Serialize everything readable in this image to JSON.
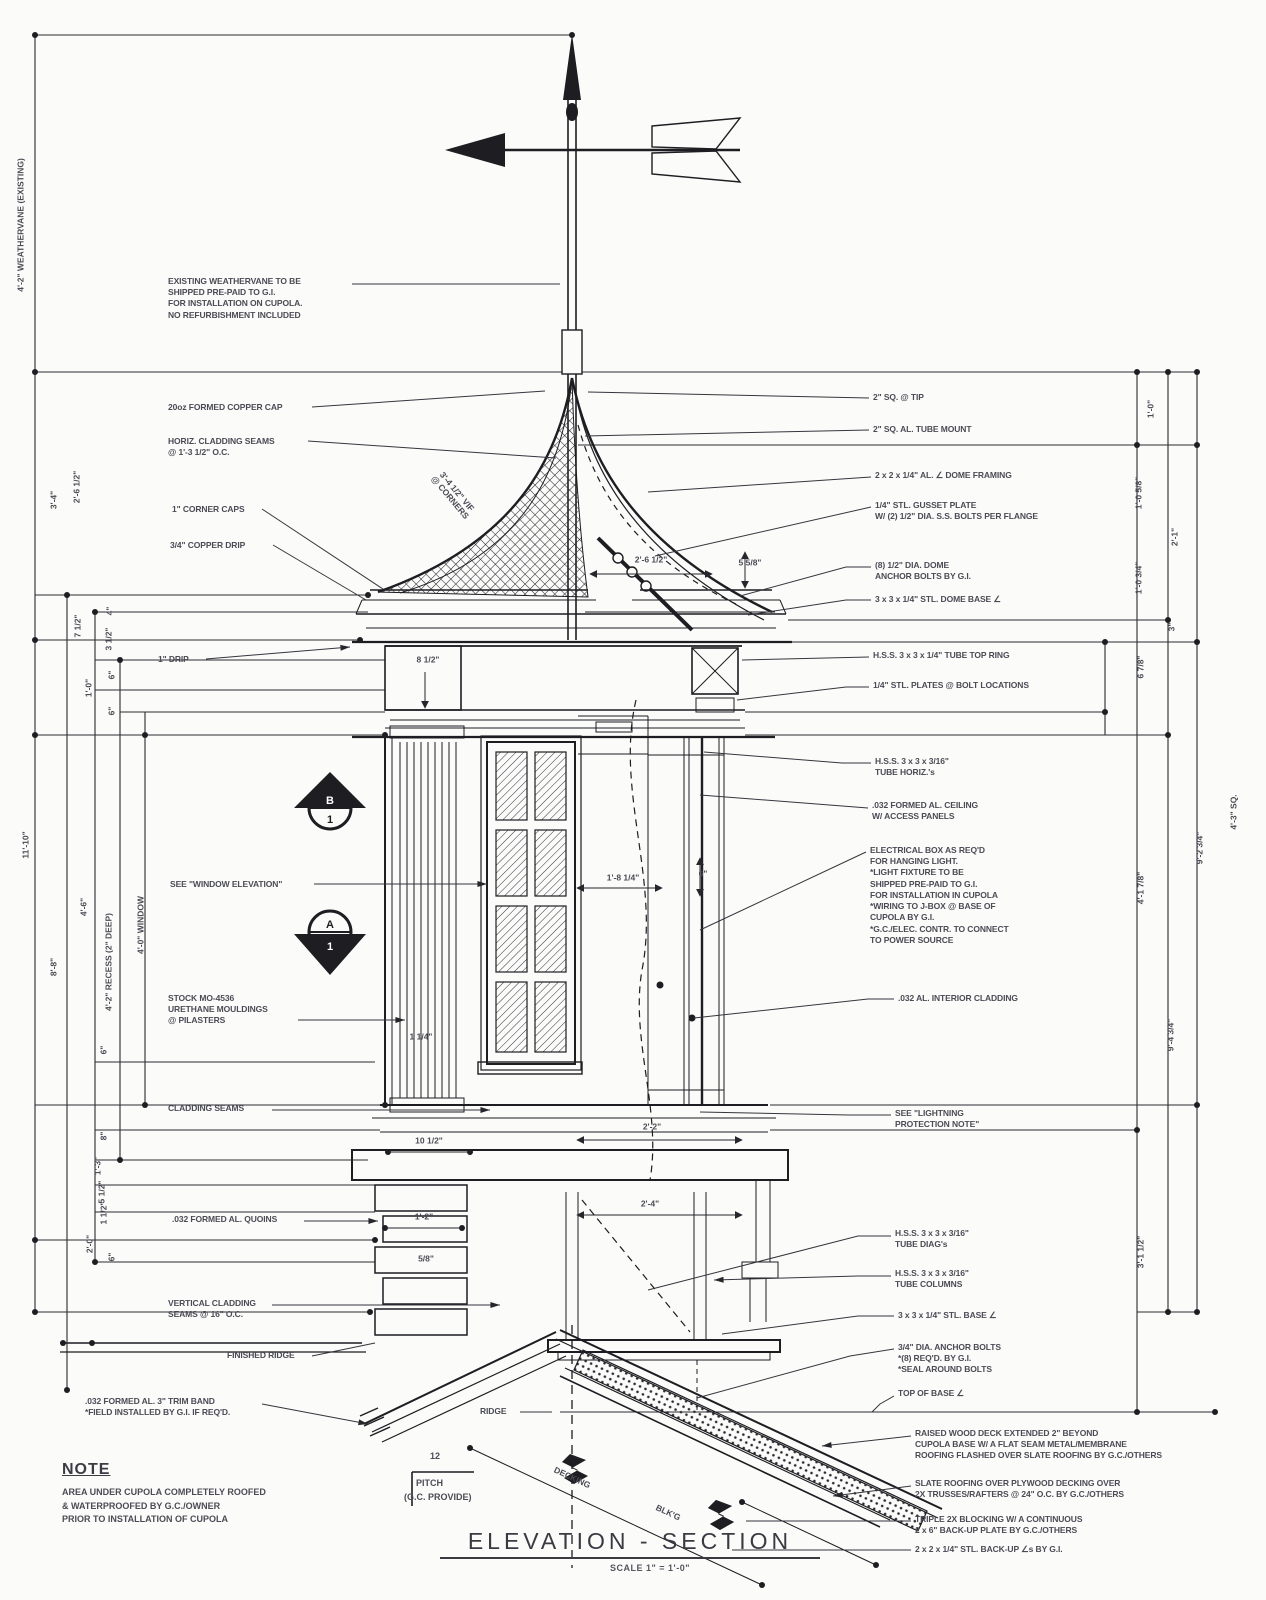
{
  "sheet": {
    "background": "#fbfbfa",
    "ink": "#26262c",
    "annotation_ink": "#4b4b55"
  },
  "title": {
    "main": "ELEVATION - SECTION",
    "scale": "SCALE 1\" = 1'-0\""
  },
  "note": {
    "heading": "NOTE",
    "body": "AREA UNDER CUPOLA COMPLETELY ROOFED\n& WATERPROOFED BY G.C./OWNER\nPRIOR TO INSTALLATION OF CUPOLA"
  },
  "pitch": {
    "rise": "12",
    "label_line1": "PITCH",
    "label_line2": "(G.C. PROVIDE)"
  },
  "section_markers": [
    {
      "top": "B",
      "bottom": "1"
    },
    {
      "top": "A",
      "bottom": "1"
    }
  ],
  "callouts": [
    {
      "name": "existing-weathervane-note",
      "x": 168,
      "y": 276,
      "text": "EXISTING WEATHERVANE TO BE\nSHIPPED PRE-PAID TO G.I.\nFOR INSTALLATION ON CUPOLA.\nNO REFURBISHMENT INCLUDED",
      "leader": [
        [
          352,
          284
        ],
        [
          560,
          284
        ]
      ],
      "arrow": false
    },
    {
      "name": "copper-cap-note",
      "x": 168,
      "y": 402,
      "text": "20oz FORMED COPPER CAP",
      "leader": [
        [
          312,
          407
        ],
        [
          545,
          391
        ]
      ],
      "arrow": false
    },
    {
      "name": "horiz-cladding-seams-note",
      "x": 168,
      "y": 436,
      "text": "HORIZ. CLADDING SEAMS\n@ 1'-3 1/2\" O.C.",
      "leader": [
        [
          308,
          441
        ],
        [
          556,
          458
        ]
      ],
      "arrow": false
    },
    {
      "name": "corner-caps-note",
      "x": 172,
      "y": 504,
      "text": "1\" CORNER CAPS",
      "leader": [
        [
          262,
          509
        ],
        [
          383,
          589
        ]
      ],
      "arrow": false
    },
    {
      "name": "copper-drip-note",
      "x": 170,
      "y": 540,
      "text": "3/4\" COPPER DRIP",
      "leader": [
        [
          273,
          545
        ],
        [
          366,
          600
        ]
      ],
      "arrow": false
    },
    {
      "name": "one-inch-drip-note",
      "x": 158,
      "y": 654,
      "text": "1\" DRIP",
      "leader": [
        [
          206,
          659
        ],
        [
          350,
          647
        ]
      ],
      "arrow": true
    },
    {
      "name": "window-elevation-note",
      "x": 170,
      "y": 879,
      "text": "SEE \"WINDOW ELEVATION\"",
      "leader": [
        [
          314,
          884
        ],
        [
          487,
          884
        ]
      ],
      "arrow": true
    },
    {
      "name": "urethane-mouldings-note",
      "x": 168,
      "y": 993,
      "text": "STOCK MO-4536\nURETHANE MOULDINGS\n@ PILASTERS",
      "leader": [
        [
          298,
          1020
        ],
        [
          405,
          1020
        ]
      ],
      "arrow": true
    },
    {
      "name": "cladding-seams-note",
      "x": 168,
      "y": 1103,
      "text": "CLADDING SEAMS",
      "leader": [
        [
          272,
          1110
        ],
        [
          490,
          1110
        ]
      ],
      "arrow": true
    },
    {
      "name": "quoins-note",
      "x": 172,
      "y": 1214,
      "text": ".032 FORMED AL. QUOINS",
      "leader": [
        [
          304,
          1221
        ],
        [
          378,
          1221
        ]
      ],
      "arrow": true
    },
    {
      "name": "vertical-cladding-seams-note",
      "x": 168,
      "y": 1298,
      "text": "VERTICAL CLADDING\nSEAMS @ 16\" O.C.",
      "leader": [
        [
          272,
          1305
        ],
        [
          500,
          1305
        ]
      ],
      "arrow": true
    },
    {
      "name": "finished-ridge-note",
      "x": 227,
      "y": 1350,
      "text": "FINISHED RIDGE",
      "leader": [
        [
          312,
          1356
        ],
        [
          375,
          1343
        ]
      ],
      "arrow": false
    },
    {
      "name": "trim-band-note",
      "x": 85,
      "y": 1396,
      "text": ".032 FORMED AL. 3\" TRIM BAND\n*FIELD INSTALLED BY G.I. IF REQ'D.",
      "leader": [
        [
          262,
          1404
        ],
        [
          368,
          1424
        ]
      ],
      "arrow": true
    },
    {
      "name": "ridge-label",
      "x": 480,
      "y": 1406,
      "text": "RIDGE",
      "leader": [
        [
          520,
          1412
        ],
        [
          552,
          1412
        ]
      ],
      "arrow": false
    },
    {
      "name": "tip-note",
      "x": 873,
      "y": 392,
      "text": "2\" SQ. @ TIP",
      "leader": [
        [
          869,
          398
        ],
        [
          588,
          392
        ]
      ],
      "arrow": false
    },
    {
      "name": "tube-mount-note",
      "x": 873,
      "y": 424,
      "text": "2\" SQ. AL. TUBE MOUNT",
      "leader": [
        [
          869,
          430
        ],
        [
          585,
          436
        ]
      ],
      "arrow": false
    },
    {
      "name": "dome-framing-note",
      "x": 875,
      "y": 470,
      "text": "2 x 2 x 1/4\" AL. ∠ DOME FRAMING",
      "leader": [
        [
          871,
          477
        ],
        [
          648,
          492
        ]
      ],
      "arrow": false
    },
    {
      "name": "gusset-plate-note",
      "x": 875,
      "y": 500,
      "text": "1/4\" STL. GUSSET PLATE\nW/ (2) 1/2\" DIA. S.S. BOLTS PER FLANGE",
      "leader": [
        [
          871,
          507
        ],
        [
          655,
          556
        ]
      ],
      "arrow": false
    },
    {
      "name": "dome-anchor-bolts-note",
      "x": 875,
      "y": 560,
      "text": "(8) 1/2\" DIA. DOME\nANCHOR BOLTS BY G.I.",
      "leader": [
        [
          871,
          567
        ],
        [
          846,
          567
        ],
        [
          740,
          596
        ]
      ],
      "arrow": false
    },
    {
      "name": "dome-base-angle-note",
      "x": 875,
      "y": 594,
      "text": "3 x 3 x 1/4\" STL. DOME BASE ∠",
      "leader": [
        [
          871,
          600
        ],
        [
          846,
          600
        ],
        [
          748,
          615
        ]
      ],
      "arrow": false
    },
    {
      "name": "tube-top-ring-note",
      "x": 873,
      "y": 650,
      "text": "H.S.S. 3 x 3 x 1/4\" TUBE TOP RING",
      "leader": [
        [
          869,
          657
        ],
        [
          742,
          660
        ]
      ],
      "arrow": false
    },
    {
      "name": "stl-plates-note",
      "x": 873,
      "y": 680,
      "text": "1/4\" STL. PLATES @ BOLT LOCATIONS",
      "leader": [
        [
          869,
          687
        ],
        [
          846,
          687
        ],
        [
          737,
          700
        ]
      ],
      "arrow": false
    },
    {
      "name": "tube-horiz-note",
      "x": 875,
      "y": 756,
      "text": "H.S.S. 3 x 3 x 3/16\"\nTUBE HORIZ.'s",
      "leader": [
        [
          871,
          763
        ],
        [
          842,
          763
        ],
        [
          704,
          752
        ]
      ],
      "arrow": false
    },
    {
      "name": "al-ceiling-note",
      "x": 872,
      "y": 800,
      "text": ".032 FORMED AL. CEILING\nW/ ACCESS PANELS",
      "leader": [
        [
          868,
          808
        ],
        [
          700,
          795
        ]
      ],
      "arrow": false
    },
    {
      "name": "electrical-box-note",
      "x": 870,
      "y": 845,
      "text": "ELECTRICAL BOX AS REQ'D\nFOR HANGING LIGHT.\n*LIGHT FIXTURE TO BE\nSHIPPED PRE-PAID TO G.I.\nFOR INSTALLATION IN CUPOLA\n*WIRING TO J-BOX @ BASE OF\nCUPOLA BY G.I.\n*G.C./ELEC. CONTR. TO CONNECT\nTO POWER SOURCE",
      "leader": [
        [
          866,
          852
        ],
        [
          700,
          930
        ]
      ],
      "arrow": false
    },
    {
      "name": "interior-cladding-note",
      "x": 898,
      "y": 993,
      "text": ".032 AL. INTERIOR CLADDING",
      "leader": [
        [
          894,
          999
        ],
        [
          868,
          999
        ],
        [
          694,
          1018
        ]
      ],
      "arrow": false
    },
    {
      "name": "lightning-protection-note",
      "x": 895,
      "y": 1108,
      "text": "SEE \"LIGHTNING\nPROTECTION NOTE\"",
      "leader": [
        [
          891,
          1115
        ],
        [
          848,
          1115
        ],
        [
          700,
          1112
        ]
      ],
      "arrow": false
    },
    {
      "name": "tube-diags-note",
      "x": 895,
      "y": 1228,
      "text": "H.S.S. 3 x 3 x 3/16\"\nTUBE DIAG's",
      "leader": [
        [
          891,
          1236
        ],
        [
          858,
          1236
        ],
        [
          648,
          1290
        ]
      ],
      "arrow": false
    },
    {
      "name": "tube-columns-note",
      "x": 895,
      "y": 1268,
      "text": "H.S.S. 3 x 3 x 3/16\"\nTUBE COLUMNS",
      "leader": [
        [
          891,
          1276
        ],
        [
          858,
          1276
        ],
        [
          714,
          1280
        ]
      ],
      "arrow": true
    },
    {
      "name": "base-angle-note",
      "x": 898,
      "y": 1310,
      "text": "3 x 3 x 1/4\" STL. BASE ∠",
      "leader": [
        [
          894,
          1316
        ],
        [
          858,
          1316
        ],
        [
          722,
          1334
        ]
      ],
      "arrow": false
    },
    {
      "name": "anchor-bolts-note",
      "x": 898,
      "y": 1342,
      "text": "3/4\" DIA. ANCHOR BOLTS\n*(8) REQ'D. BY G.I.\n*SEAL AROUND BOLTS",
      "leader": [
        [
          894,
          1349
        ],
        [
          850,
          1356
        ],
        [
          697,
          1398
        ]
      ],
      "arrow": false
    },
    {
      "name": "top-of-base-note",
      "x": 898,
      "y": 1388,
      "text": "TOP OF BASE ∠",
      "leader": [
        [
          894,
          1396
        ],
        [
          880,
          1404
        ],
        [
          872,
          1412
        ]
      ],
      "arrow": false
    },
    {
      "name": "raised-deck-note",
      "x": 915,
      "y": 1428,
      "text": "RAISED WOOD DECK EXTENDED 2\" BEYOND\nCUPOLA BASE W/ A FLAT SEAM METAL/MEMBRANE\nROOFING FLASHED OVER SLATE ROOFING BY G.C./OTHERS",
      "leader": [
        [
          911,
          1436
        ],
        [
          822,
          1446
        ]
      ],
      "arrow": true
    },
    {
      "name": "slate-roofing-note",
      "x": 915,
      "y": 1478,
      "text": "SLATE ROOFING OVER PLYWOOD DECKING OVER\n2X TRUSSES/RAFTERS @ 24\" O.C. BY G.C./OTHERS",
      "leader": [
        [
          911,
          1486
        ],
        [
          833,
          1496
        ]
      ],
      "arrow": true
    },
    {
      "name": "blocking-note",
      "x": 915,
      "y": 1514,
      "text": "TRIPLE 2X BLOCKING W/ A CONTINUOUS\n2 x 6\" BACK-UP PLATE BY G.C./OTHERS",
      "leader": [
        [
          911,
          1521
        ],
        [
          746,
          1521
        ]
      ],
      "arrow": false
    },
    {
      "name": "backup-angles-note",
      "x": 915,
      "y": 1544,
      "text": "2 x 2 x 1/4\" STL. BACK-UP ∠s BY G.I.",
      "leader": [
        [
          911,
          1550
        ],
        [
          732,
          1550
        ]
      ],
      "arrow": false
    }
  ],
  "dims": [
    {
      "text": "4'-2\" WEATHERVANE (EXISTING)",
      "x": 21,
      "y": 225,
      "rot": -90
    },
    {
      "text": "3'-4\"",
      "x": 54,
      "y": 500,
      "rot": -90
    },
    {
      "text": "2'-6 1/2\"",
      "x": 77,
      "y": 487,
      "rot": -90
    },
    {
      "text": "11'-10\"",
      "x": 26,
      "y": 845,
      "rot": -90
    },
    {
      "text": "8'-8\"",
      "x": 54,
      "y": 967,
      "rot": -90
    },
    {
      "text": "4'-6\"",
      "x": 84,
      "y": 907,
      "rot": -90
    },
    {
      "text": "4'-2\" RECESS (2\" DEEP)",
      "x": 109,
      "y": 962,
      "rot": -90
    },
    {
      "text": "4'-0\" WINDOW",
      "x": 141,
      "y": 925,
      "rot": -90
    },
    {
      "text": "4\"",
      "x": 110,
      "y": 611,
      "rot": -90
    },
    {
      "text": "7 1/2\"",
      "x": 78,
      "y": 626,
      "rot": -90
    },
    {
      "text": "3 1/2\"",
      "x": 109,
      "y": 639,
      "rot": -90
    },
    {
      "text": "6\"",
      "x": 112,
      "y": 675,
      "rot": -90
    },
    {
      "text": "1'-0\"",
      "x": 89,
      "y": 688,
      "rot": -90
    },
    {
      "text": "6\"",
      "x": 112,
      "y": 711,
      "rot": -90
    },
    {
      "text": "6\"",
      "x": 104,
      "y": 1050,
      "rot": -90
    },
    {
      "text": "8\"",
      "x": 104,
      "y": 1136,
      "rot": -90
    },
    {
      "text": "1'-3\"",
      "x": 98,
      "y": 1166,
      "rot": -90
    },
    {
      "text": "5 1/2\"",
      "x": 102,
      "y": 1192,
      "rot": -90
    },
    {
      "text": "1 1/2\"",
      "x": 104,
      "y": 1213,
      "rot": -90
    },
    {
      "text": "2'-0\"",
      "x": 90,
      "y": 1244,
      "rot": -90
    },
    {
      "text": "6\"",
      "x": 112,
      "y": 1257,
      "rot": -90
    },
    {
      "text": "1'-0\"",
      "x": 1151,
      "y": 409,
      "rot": -90
    },
    {
      "text": "1'-0 5/8\"",
      "x": 1139,
      "y": 493,
      "rot": -90
    },
    {
      "text": "2'-1\"",
      "x": 1175,
      "y": 537,
      "rot": -90
    },
    {
      "text": "1'-0 3/4\"",
      "x": 1139,
      "y": 578,
      "rot": -90
    },
    {
      "text": "3\"",
      "x": 1172,
      "y": 627,
      "rot": -90
    },
    {
      "text": "6 7/8\"",
      "x": 1141,
      "y": 667,
      "rot": -90
    },
    {
      "text": "4'-1 7/8\"",
      "x": 1141,
      "y": 888,
      "rot": -90
    },
    {
      "text": "9'-2 3/4\"",
      "x": 1200,
      "y": 848,
      "rot": -90
    },
    {
      "text": "9'-4 3/4\"",
      "x": 1171,
      "y": 1035,
      "rot": -90
    },
    {
      "text": "3'-1 1/2\"",
      "x": 1141,
      "y": 1252,
      "rot": -90
    },
    {
      "text": "4'-3\" SQ.",
      "x": 1234,
      "y": 812,
      "rot": -90
    },
    {
      "text": "8 1/2\"",
      "x": 428,
      "y": 660,
      "rot": 0
    },
    {
      "text": "2'-6 1/2\"",
      "x": 651,
      "y": 560,
      "rot": 0
    },
    {
      "text": "5 5/8\"",
      "x": 750,
      "y": 563,
      "rot": 0
    },
    {
      "text": "1'-8 1/4\"",
      "x": 623,
      "y": 878,
      "rot": 0
    },
    {
      "text": "6\"",
      "x": 703,
      "y": 874,
      "rot": 0
    },
    {
      "text": "1 1/4\"",
      "x": 421,
      "y": 1037,
      "rot": 0
    },
    {
      "text": "10 1/2\"",
      "x": 429,
      "y": 1141,
      "rot": 0
    },
    {
      "text": "2'-2\"",
      "x": 652,
      "y": 1127,
      "rot": 0
    },
    {
      "text": "1'-2\"",
      "x": 424,
      "y": 1217,
      "rot": 0
    },
    {
      "text": "5/8\"",
      "x": 426,
      "y": 1259,
      "rot": 0
    },
    {
      "text": "2'-4\"",
      "x": 650,
      "y": 1204,
      "rot": 0
    },
    {
      "text": "3'-4 1/2\" VIF\n@ CORNERS",
      "x": 453,
      "y": 495,
      "rot": 50
    },
    {
      "text": "DECKING",
      "x": 572,
      "y": 1478,
      "rot": 25
    },
    {
      "text": "BLK'G",
      "x": 668,
      "y": 1513,
      "rot": 25
    }
  ]
}
